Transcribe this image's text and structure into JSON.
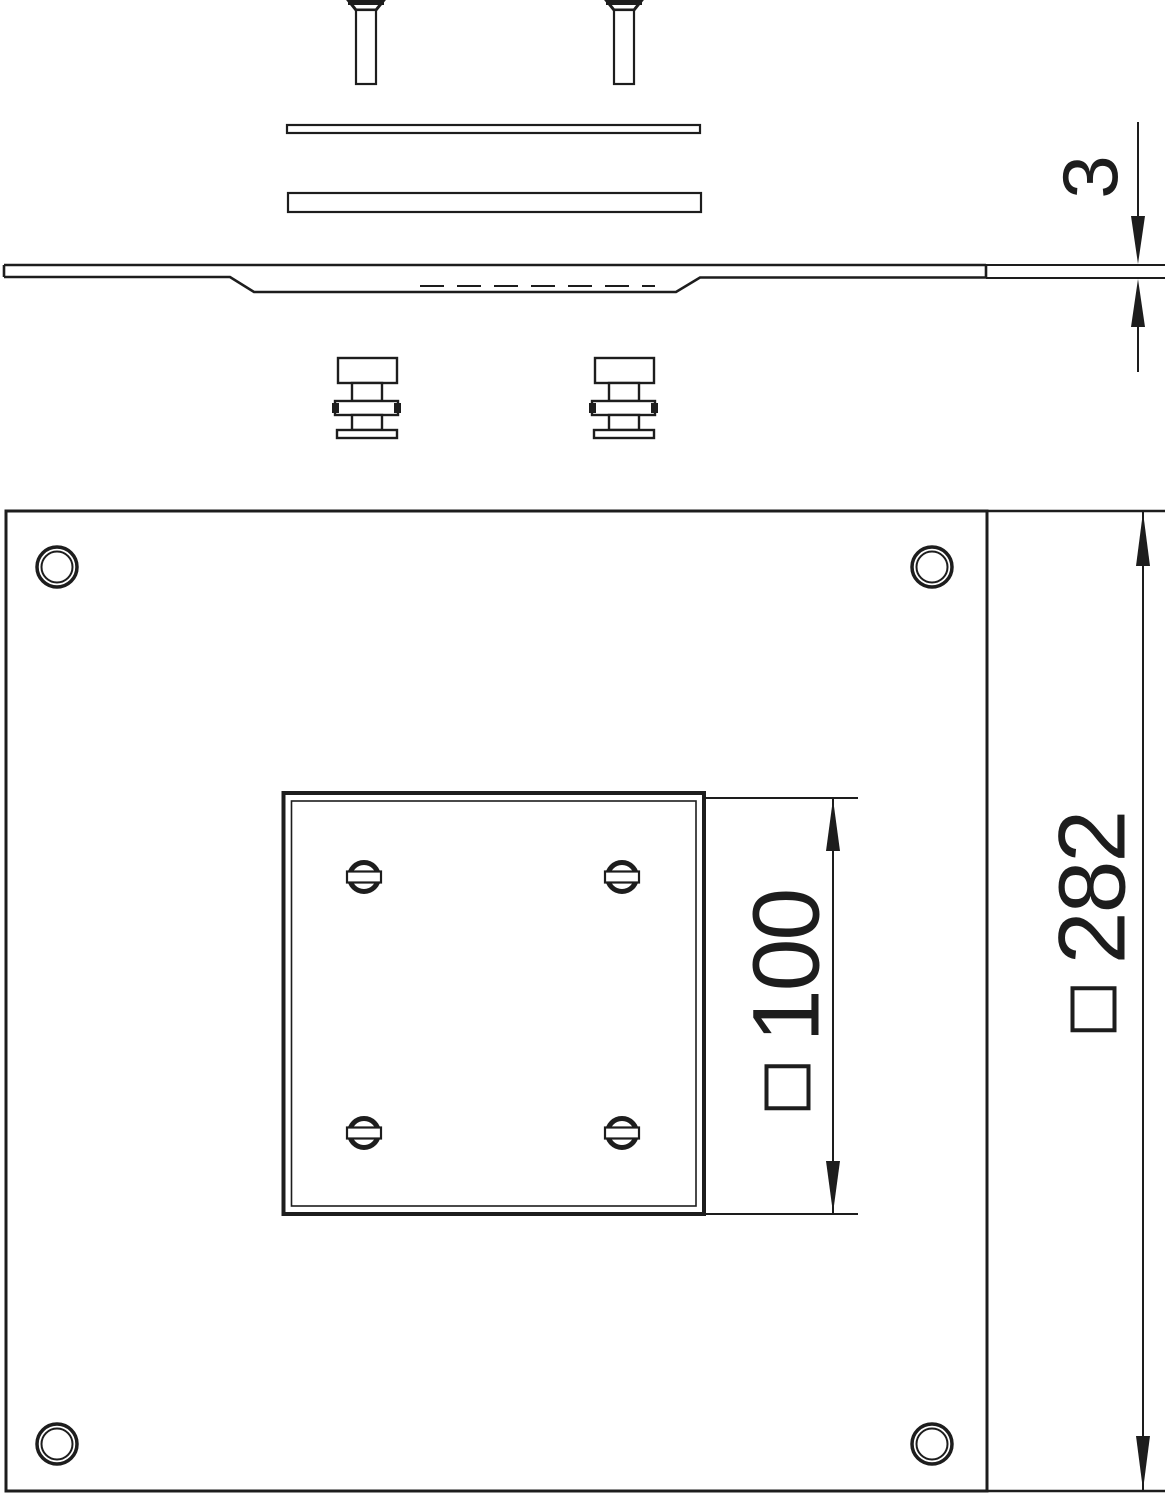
{
  "drawing": {
    "background_color": "#ffffff",
    "line_color": "#1d1d1d",
    "dimensions": {
      "thickness": {
        "value": "3"
      },
      "cutout": {
        "symbol": "□",
        "value": "100"
      },
      "plate": {
        "symbol": "□",
        "value": "282"
      }
    }
  }
}
